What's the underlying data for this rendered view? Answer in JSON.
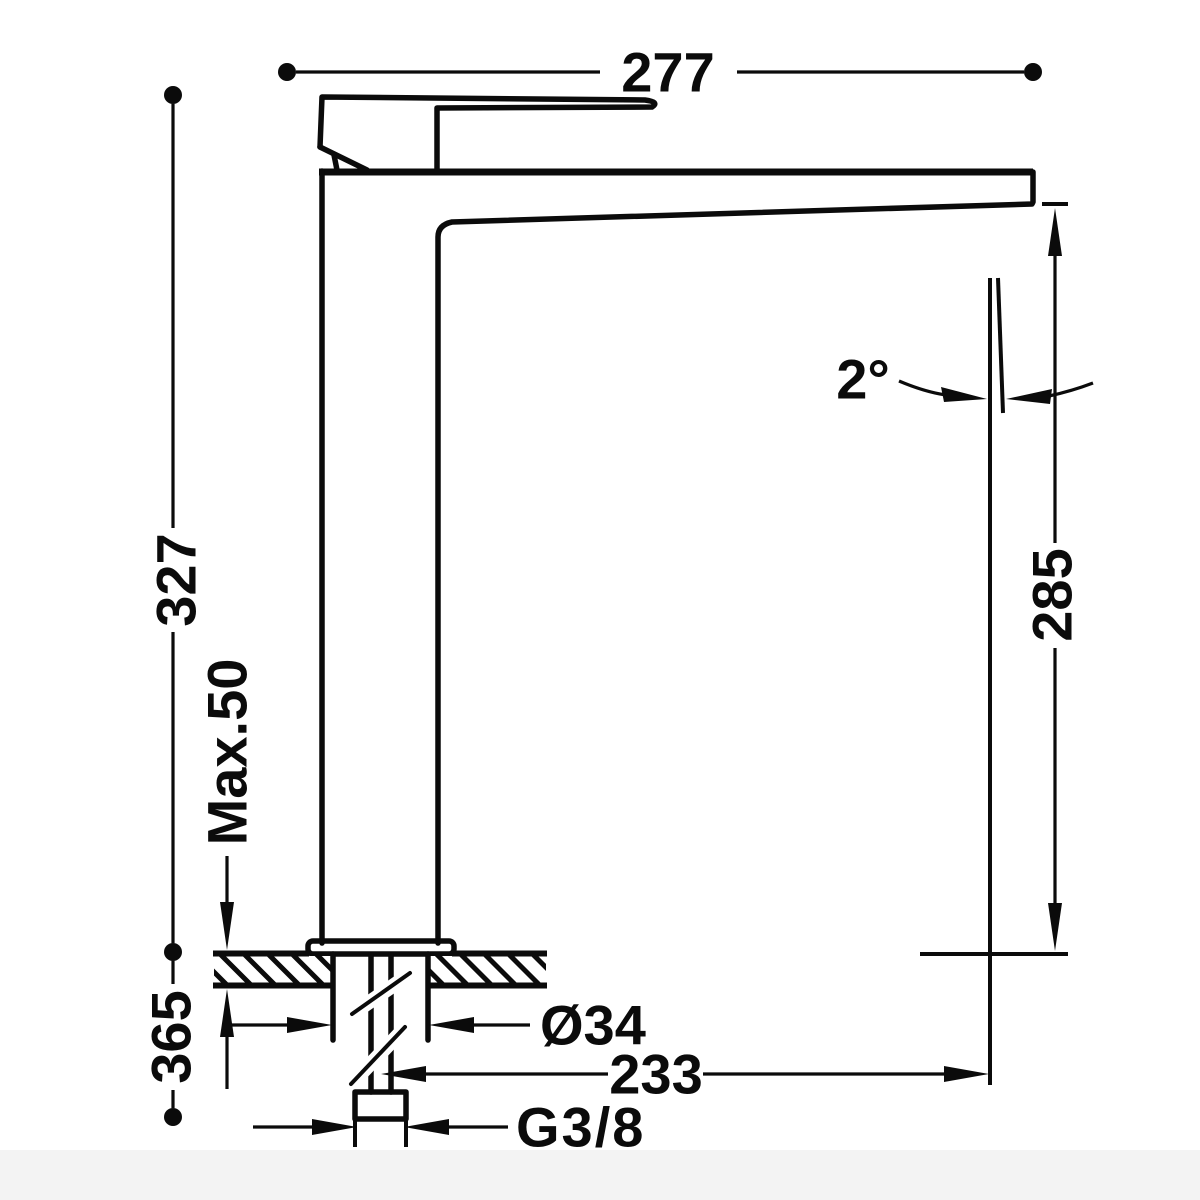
{
  "drawing": {
    "type": "faucet-dimensional-drawing",
    "colors": {
      "ink": "#0b0b0b",
      "background": "#ffffff",
      "footer_strip": "#f3f3f3"
    },
    "dimensions": {
      "spout_width": {
        "label": "277"
      },
      "total_height": {
        "label": "327"
      },
      "max_deck_thickness": {
        "label": "Max.50"
      },
      "under_counter_height": {
        "label": "365"
      },
      "outlet_height": {
        "label": "285"
      },
      "outlet_angle": {
        "label": "2°"
      },
      "shank_diameter": {
        "label": "Ø34"
      },
      "outlet_projection": {
        "label": "233"
      },
      "thread_size": {
        "label": "G3/8"
      }
    }
  }
}
